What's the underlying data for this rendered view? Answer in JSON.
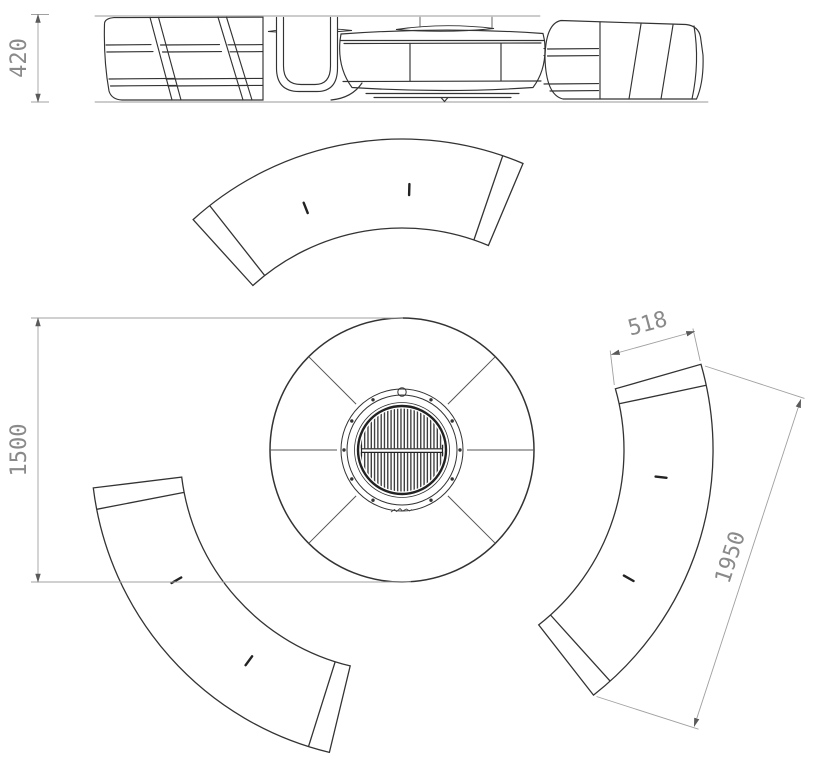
{
  "drawing": {
    "dimensions": {
      "elevation_height": "420",
      "plan_overall": "1500",
      "bench_width": "518",
      "bench_length": "1950"
    },
    "colors": {
      "outline": "#333333",
      "light_line": "#6e6e6e",
      "dimension_line": "#a0a0a0",
      "dimension_text": "#8a8a8a",
      "arrow": "#5a5a5a",
      "grill_dark": "#2d2d2d",
      "background": "#ffffff"
    }
  }
}
